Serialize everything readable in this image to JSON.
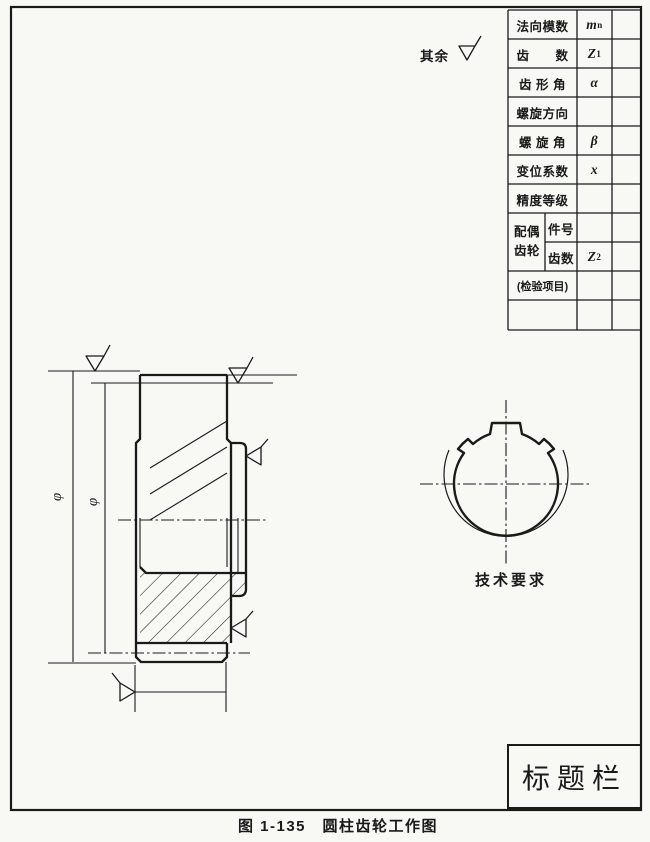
{
  "drawing": {
    "surface_note": "其余",
    "caption": "图 1-135　圆柱齿轮工作图",
    "tech_req_label": "技术要求",
    "phi_symbol": "φ",
    "title_block_label": "标题栏"
  },
  "param_table": {
    "rows": [
      {
        "label": "法向模数",
        "sym_base": "m",
        "sym_sub": "n"
      },
      {
        "label": "齿　　数",
        "sym_base": "Z",
        "sym_sub": "1"
      },
      {
        "label": "齿 形 角",
        "sym_base": "α",
        "sym_sub": ""
      },
      {
        "label": "螺旋方向",
        "sym_base": "",
        "sym_sub": ""
      },
      {
        "label": "螺 旋 角",
        "sym_base": "β",
        "sym_sub": ""
      },
      {
        "label": "变位系数",
        "sym_base": "x",
        "sym_sub": ""
      },
      {
        "label": "精度等级",
        "sym_base": "",
        "sym_sub": ""
      }
    ],
    "mate_group": {
      "line1": "配偶",
      "line2": "齿轮",
      "part_no_label": "件号",
      "teeth_label": "齿数",
      "teeth_sym_base": "Z",
      "teeth_sym_sub": "2"
    },
    "inspection_label": "(检验项目)"
  }
}
